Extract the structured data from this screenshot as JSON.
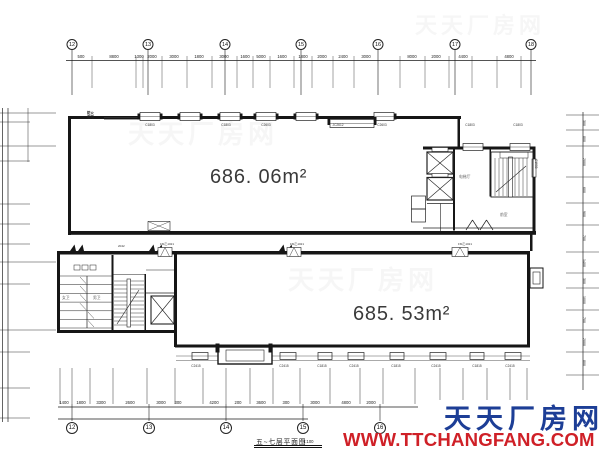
{
  "drawing": {
    "title": "五~七层平面图",
    "scale": "1:100",
    "area_upper": "686. 06m²",
    "area_lower": "685. 53m²"
  },
  "watermark": {
    "brand": "天天厂房网",
    "url": "WWW.TTCHANGFANG.COM",
    "brand_color": "#1d3e96",
    "url_color": "#cf2027",
    "ghost": "天天厂房网"
  },
  "grid_bubbles": {
    "top": [
      {
        "x": 72,
        "v": "12"
      },
      {
        "x": 148,
        "v": "13"
      },
      {
        "x": 225,
        "v": "14"
      },
      {
        "x": 301,
        "v": "15"
      },
      {
        "x": 378,
        "v": "16"
      },
      {
        "x": 455,
        "v": "17"
      },
      {
        "x": 531,
        "v": "18"
      }
    ],
    "bottom": [
      {
        "x": 72,
        "v": "12"
      },
      {
        "x": 149,
        "v": "13"
      },
      {
        "x": 226,
        "v": "14"
      },
      {
        "x": 303,
        "v": "15"
      },
      {
        "x": 380,
        "v": "16"
      }
    ]
  },
  "dimensions": {
    "top": [
      {
        "x": 81,
        "v": "500"
      },
      {
        "x": 114,
        "v": "8800"
      },
      {
        "x": 139,
        "v": "1300"
      },
      {
        "x": 152,
        "v": "2000"
      },
      {
        "x": 174,
        "v": "3000"
      },
      {
        "x": 199,
        "v": "1800"
      },
      {
        "x": 224,
        "v": "3000"
      },
      {
        "x": 245,
        "v": "1600"
      },
      {
        "x": 261,
        "v": "5000"
      },
      {
        "x": 282,
        "v": "1600"
      },
      {
        "x": 303,
        "v": "1800"
      },
      {
        "x": 322,
        "v": "2000"
      },
      {
        "x": 343,
        "v": "2400"
      },
      {
        "x": 366,
        "v": "3000"
      },
      {
        "x": 412,
        "v": "8000"
      },
      {
        "x": 436,
        "v": "2000"
      },
      {
        "x": 463,
        "v": "4400"
      },
      {
        "x": 509,
        "v": "4800"
      }
    ],
    "bottom": [
      {
        "x": 64,
        "v": "1400"
      },
      {
        "x": 81,
        "v": "1800"
      },
      {
        "x": 101,
        "v": "3300"
      },
      {
        "x": 130,
        "v": "2600"
      },
      {
        "x": 161,
        "v": "3000"
      },
      {
        "x": 178,
        "v": "300"
      },
      {
        "x": 214,
        "v": "4200"
      },
      {
        "x": 238,
        "v": "200"
      },
      {
        "x": 261,
        "v": "3600"
      },
      {
        "x": 286,
        "v": "300"
      },
      {
        "x": 315,
        "v": "3000"
      },
      {
        "x": 346,
        "v": "4800"
      },
      {
        "x": 371,
        "v": "2000"
      }
    ],
    "right": [
      {
        "y": 120,
        "v": "300"
      },
      {
        "y": 136,
        "v": "800"
      },
      {
        "y": 158,
        "v": "2000"
      },
      {
        "y": 187,
        "v": "600"
      },
      {
        "y": 211,
        "v": "900"
      },
      {
        "y": 235,
        "v": "700"
      },
      {
        "y": 259,
        "v": "1400"
      },
      {
        "y": 278,
        "v": "300"
      },
      {
        "y": 296,
        "v": "1000"
      },
      {
        "y": 317,
        "v": "700"
      },
      {
        "y": 338,
        "v": "2000"
      },
      {
        "y": 360,
        "v": "800"
      }
    ]
  },
  "labels": {
    "fire_shutter": "防火\n卷帘",
    "side_window": "C1503",
    "windows_top": [
      {
        "x": 150,
        "v": "C1803"
      },
      {
        "x": 226,
        "v": "C1803"
      },
      {
        "x": 266,
        "v": "C2603"
      },
      {
        "x": 338,
        "v": "JC2612"
      },
      {
        "x": 382,
        "v": "C2603"
      },
      {
        "x": 470,
        "v": "C1803"
      },
      {
        "x": 518,
        "v": "C1803"
      }
    ],
    "windows_bottom": [
      {
        "x": 196,
        "v": "C2415"
      },
      {
        "x": 284,
        "v": "C2415"
      },
      {
        "x": 322,
        "v": "C1815"
      },
      {
        "x": 354,
        "v": "C2415"
      },
      {
        "x": 396,
        "v": "C1815"
      },
      {
        "x": 436,
        "v": "C2415"
      },
      {
        "x": 477,
        "v": "C1815"
      },
      {
        "x": 510,
        "v": "C2415"
      }
    ],
    "doors": [
      {
        "x": 160,
        "y": 242,
        "v": "FM乙1021"
      },
      {
        "x": 290,
        "y": 242,
        "v": "FM乙1021"
      },
      {
        "x": 458,
        "y": 242,
        "v": "FM乙1021"
      },
      {
        "x": 118,
        "y": 243.5,
        "v": "2042"
      }
    ],
    "rooms": [
      {
        "x": 459,
        "y": 175,
        "v": "电梯厅"
      },
      {
        "x": 500,
        "y": 213,
        "v": "前室"
      },
      {
        "x": 62,
        "y": 296,
        "v": "女卫"
      },
      {
        "x": 93,
        "y": 296,
        "v": "男卫"
      }
    ]
  }
}
